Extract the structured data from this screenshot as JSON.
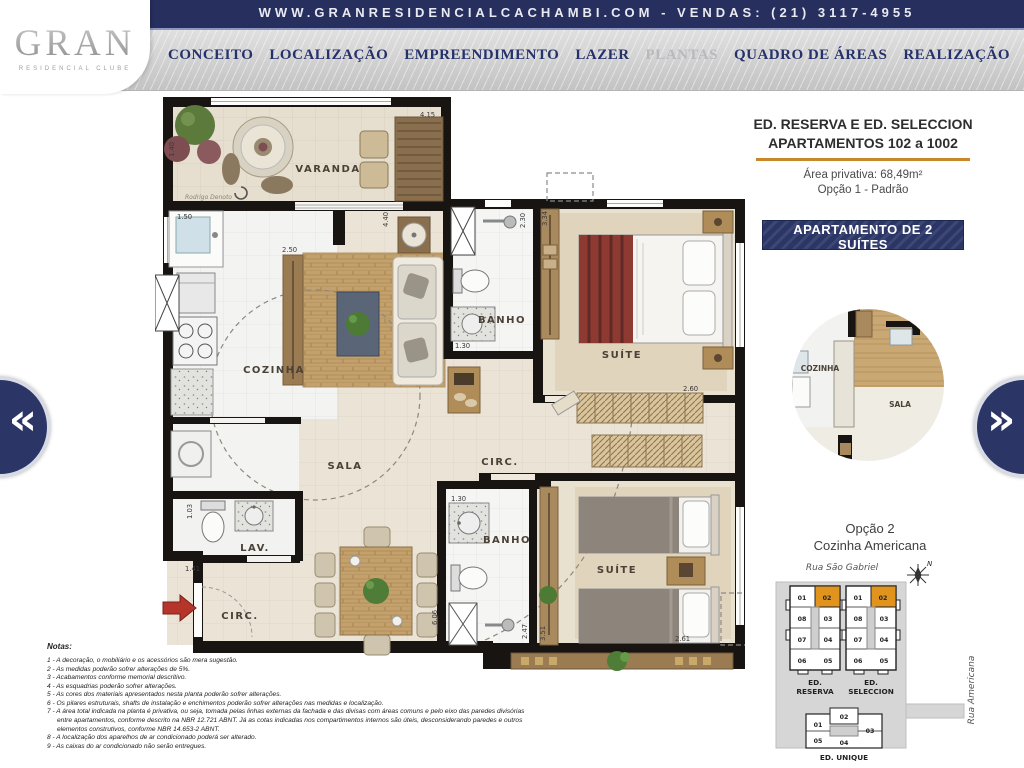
{
  "topbar": {
    "text": "WWW.GRANRESIDENCIALCACHAMBI.COM - VENDAS: (21) 3117-4955"
  },
  "logo": {
    "name": "GRAN",
    "subtitle": "RESIDENCIAL CLUBE"
  },
  "nav": {
    "items": [
      {
        "label": "CONCEITO"
      },
      {
        "label": "LOCALIZAÇÃO"
      },
      {
        "label": "EMPREENDIMENTO"
      },
      {
        "label": "LAZER"
      },
      {
        "label": "PLANTAS"
      },
      {
        "label": "QUADRO DE ÁREAS"
      },
      {
        "label": "REALIZAÇÃO"
      }
    ]
  },
  "panel": {
    "title_line1": "ED. RESERVA E ED. SELECCION",
    "title_line2": "APARTAMENTOS 102 a 1002",
    "area": "Área privativa: 68,49m²",
    "option": "Opção 1 - Padrão",
    "button": "APARTAMENTO DE 2 SUÍTES",
    "accent_color": "#c8872a",
    "button_color": "#2b3566"
  },
  "plan": {
    "signature": "Rodrigo Denoto",
    "rooms": {
      "varanda": "VARANDA",
      "cozinha": "COZINHA",
      "sala": "SALA",
      "banho1": "BANHO",
      "suite1": "SUÍTE",
      "circ1": "CIRC.",
      "lav": "LAV.",
      "banho2": "BANHO",
      "suite2": "SUÍTE",
      "circ2": "CIRC."
    },
    "dims": {
      "varanda_w": "4.15",
      "varanda_d": "1.40",
      "cozinha_w": "1.50",
      "sala_h": "4.40",
      "sideboard": "2.50",
      "banho1_d": "2.30",
      "wardrobe1": "3.34",
      "banho1_w": "1.30",
      "suite1_w": "2.60",
      "lav_d": "1.03",
      "lav_w": "1.41",
      "banho2_w": "1.30",
      "banho2_d": "2.47",
      "suite2_d": "3.51",
      "sala_d": "6.06",
      "suite2_w": "2.61"
    }
  },
  "inset": {
    "cozinha": "COZINHA",
    "sala": "SALA",
    "caption_line1": "Opção 2",
    "caption_line2": "Cozinha Americana"
  },
  "siteplan": {
    "street_top": "Rua São Gabriel",
    "street_right": "Rua Americana",
    "north": "N",
    "highlight_color": "#e0941e",
    "reserva": {
      "label1": "ED.",
      "label2": "RESERVA",
      "units": [
        "01",
        "02",
        "08",
        "03",
        "07",
        "04",
        "06",
        "05"
      ]
    },
    "seleccion": {
      "label1": "ED.",
      "label2": "SELECCION",
      "units": [
        "01",
        "02",
        "08",
        "03",
        "07",
        "04",
        "06",
        "05"
      ]
    },
    "unique": {
      "label": "ED. UNIQUE",
      "units": [
        "01",
        "02",
        "03",
        "05",
        "04"
      ]
    }
  },
  "notes": {
    "heading": "Notas:",
    "items": [
      "1 - A decoração, o mobiliário e os acessórios são mera sugestão.",
      "2 - As medidas poderão sofrer alterações de 5%.",
      "3 - Acabamentos conforme memorial descritivo.",
      "4 - As esquadrias poderão sofrer alterações.",
      "5 - As cores dos materiais apresentados nesta planta poderão sofrer alterações.",
      "6 - Os pilares estruturais, shafts de instalação e enchimentos poderão sofrer alterações nas medidas e localização.",
      "7 - A área total indicada na planta é privativa, ou seja, tomada pelas linhas externas da fachada e das divisas com áreas comuns e pelo eixo das paredes divisórias entre apartamentos, conforme descrito na NBR 12.721 ABNT. Já as cotas indicadas nos compartimentos internos são úteis, desconsiderando paredes e outros elementos construtivos, conforme NBR 14.653-2 ABNT.",
      "8 - A localização dos aparelhos de ar condicionado poderá ser alterado.",
      "9 - As caixas do ar condicionado não serão entregues."
    ]
  },
  "carousel": {
    "prev": "«",
    "next": "»"
  }
}
